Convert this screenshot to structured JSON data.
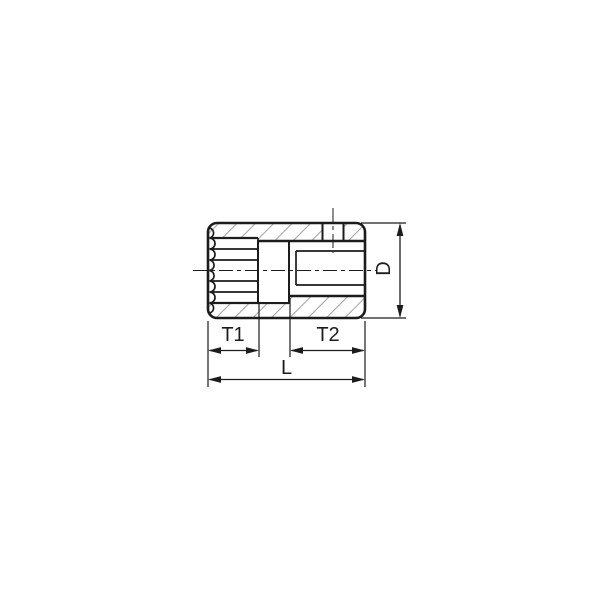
{
  "drawing": {
    "dimensions": {
      "t1": "T1",
      "t2": "T2",
      "length": "L",
      "diameter": "D"
    }
  },
  "colors": {
    "line": "#1c1c1c",
    "hatch": "#a6a6a6",
    "background": "#ffffff"
  }
}
